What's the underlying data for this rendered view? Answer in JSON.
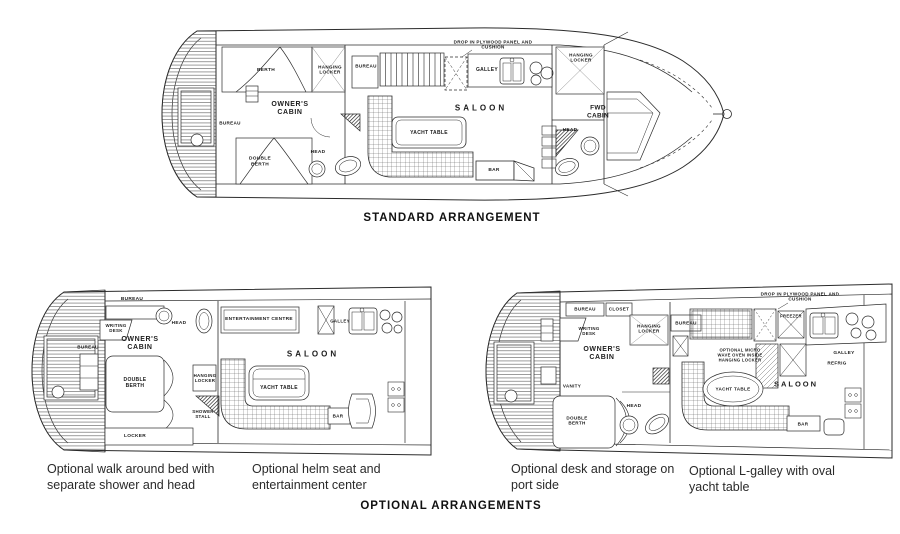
{
  "colors": {
    "ink": "#2b2b2b",
    "paper": "#ffffff"
  },
  "standard": {
    "title": "STANDARD ARRANGEMENT",
    "berth": "BERTH",
    "hanging_locker_aft": "HANGING LOCKER",
    "bureau_mid": "BUREAU",
    "drop_in_panel": "DROP IN PLYWOOD PANEL AND CUSHION",
    "galley": "GALLEY",
    "hanging_locker_fwd": "HANGING LOCKER",
    "saloon": "SALOON",
    "yacht_table": "YACHT TABLE",
    "bar": "BAR",
    "owners_cabin": "OWNER'S CABIN",
    "bureau_aft": "BUREAU",
    "double_berth": "DOUBLE BERTH",
    "head_aft": "HEAD",
    "fwd_cabin": "FWD CABIN",
    "head_fwd": "HEAD"
  },
  "optional_left": {
    "caption_bed": "Optional walk around bed with separate shower and head",
    "caption_helm": "Optional helm seat and entertainment center",
    "bureau_top": "BUREAU",
    "writing_desk": "WRITING DESK",
    "head": "HEAD",
    "entertainment_centre": "ENTERTAINMENT CENTRE",
    "galley": "GALLEY",
    "owners_cabin": "OWNER'S CABIN",
    "bureau_left": "BUREAU",
    "double_berth": "DOUBLE BERTH",
    "saloon": "SALOON",
    "yacht_table": "YACHT TABLE",
    "hanging_locker": "HANGING LOCKER",
    "shower_stall": "SHOWER STALL",
    "bar": "BAR",
    "locker": "LOCKER"
  },
  "optional_right": {
    "caption_desk": "Optional desk and storage on port side",
    "caption_galley": "Optional L-galley with oval yacht table",
    "bureau_top": "BUREAU",
    "closet": "CLOSET",
    "writing_desk": "WRITING DESK",
    "hanging_locker": "HANGING LOCKER",
    "bureau_fwd": "BUREAU",
    "owners_cabin": "OWNER'S CABIN",
    "vanity": "VANITY",
    "double_berth": "DOUBLE BERTH",
    "head": "HEAD",
    "drop_in_panel": "DROP IN PLYWOOD PANEL AND CUSHION",
    "freezer": "FREEZER",
    "microwave_note": "OPTIONAL MICRO WAVE OVEN INSIDE HANGING LOCKER",
    "galley": "GALLEY",
    "refrig": "REFRIG",
    "saloon": "SALOON",
    "yacht_table": "YACHT TABLE",
    "bar": "BAR"
  },
  "optional_title": "OPTIONAL ARRANGEMENTS"
}
